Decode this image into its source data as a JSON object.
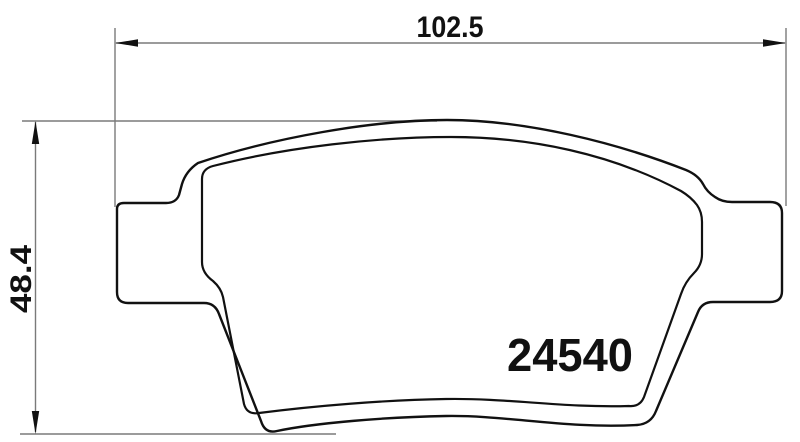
{
  "part": {
    "number": "24540"
  },
  "dimensions": {
    "width_label": "102.5",
    "height_label": "48.4"
  },
  "colors": {
    "outline": "#111111",
    "dimension_line": "#7a7a7a",
    "arrow_fill": "#111111",
    "background": "#ffffff"
  }
}
